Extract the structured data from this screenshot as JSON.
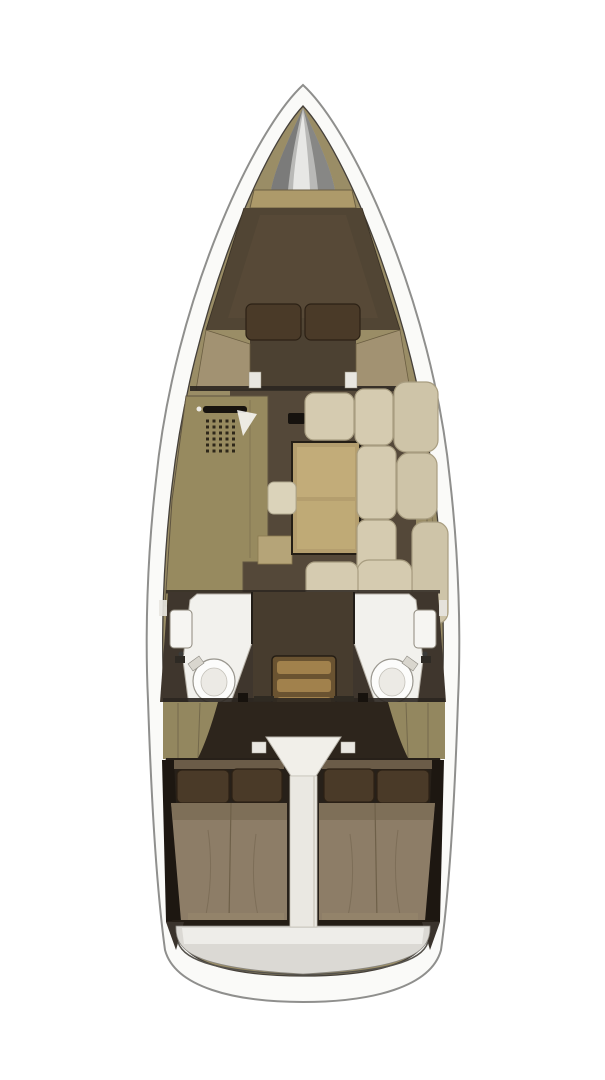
{
  "figure": {
    "type": "yacht-interior-floor-plan",
    "view": "top-down",
    "regions": [
      "bow-anchor-locker",
      "forward-v-berth-cabin",
      "main-salon",
      "galley",
      "dinette-table",
      "settee",
      "port-head-bathroom",
      "starboard-head-bathroom",
      "companionway-stairs",
      "port-aft-cabin",
      "starboard-aft-cabin",
      "stern-swim-platform"
    ]
  },
  "colors": {
    "background": "#ffffff",
    "hull_white": "#fafaf8",
    "hull_stroke": "#8f8f8d",
    "deck_khaki": "#9a8d66",
    "metal_cone": "#b9b9b7",
    "wood_shelf": "#ad9a6a",
    "berth_dark": "#51453 4",
    "berth_fill": "#514534",
    "berth_light": "#5a4c39",
    "pillow_brown": "#4a3a28",
    "pillow_stroke": "#2c2115",
    "floor_brown": "#544839",
    "galley_khaki": "#978a5f",
    "white_surface": "#f2f1ed",
    "table_wood": "#b49e6e",
    "table_light": "#c3ad7a",
    "cushion_cream": "#d5cbb0",
    "cushion_back": "#cec4a8",
    "cushion_stroke": "#a89d80",
    "stool_cream": "#dbd3ba",
    "stairs_base": "#6a5331",
    "stairs_tread": "#a1814c",
    "head_wall": "#3f362d",
    "toilet_white": "#fcfcfb",
    "aft_dark": "#2d251c",
    "aft_shadow": "#272019",
    "bed_mattress": "#8d7d67",
    "bed_head": "#6b5c48",
    "stern_light": "#dbd9d4",
    "line_dark": "#2b2620",
    "column_white": "#eae8e2"
  }
}
